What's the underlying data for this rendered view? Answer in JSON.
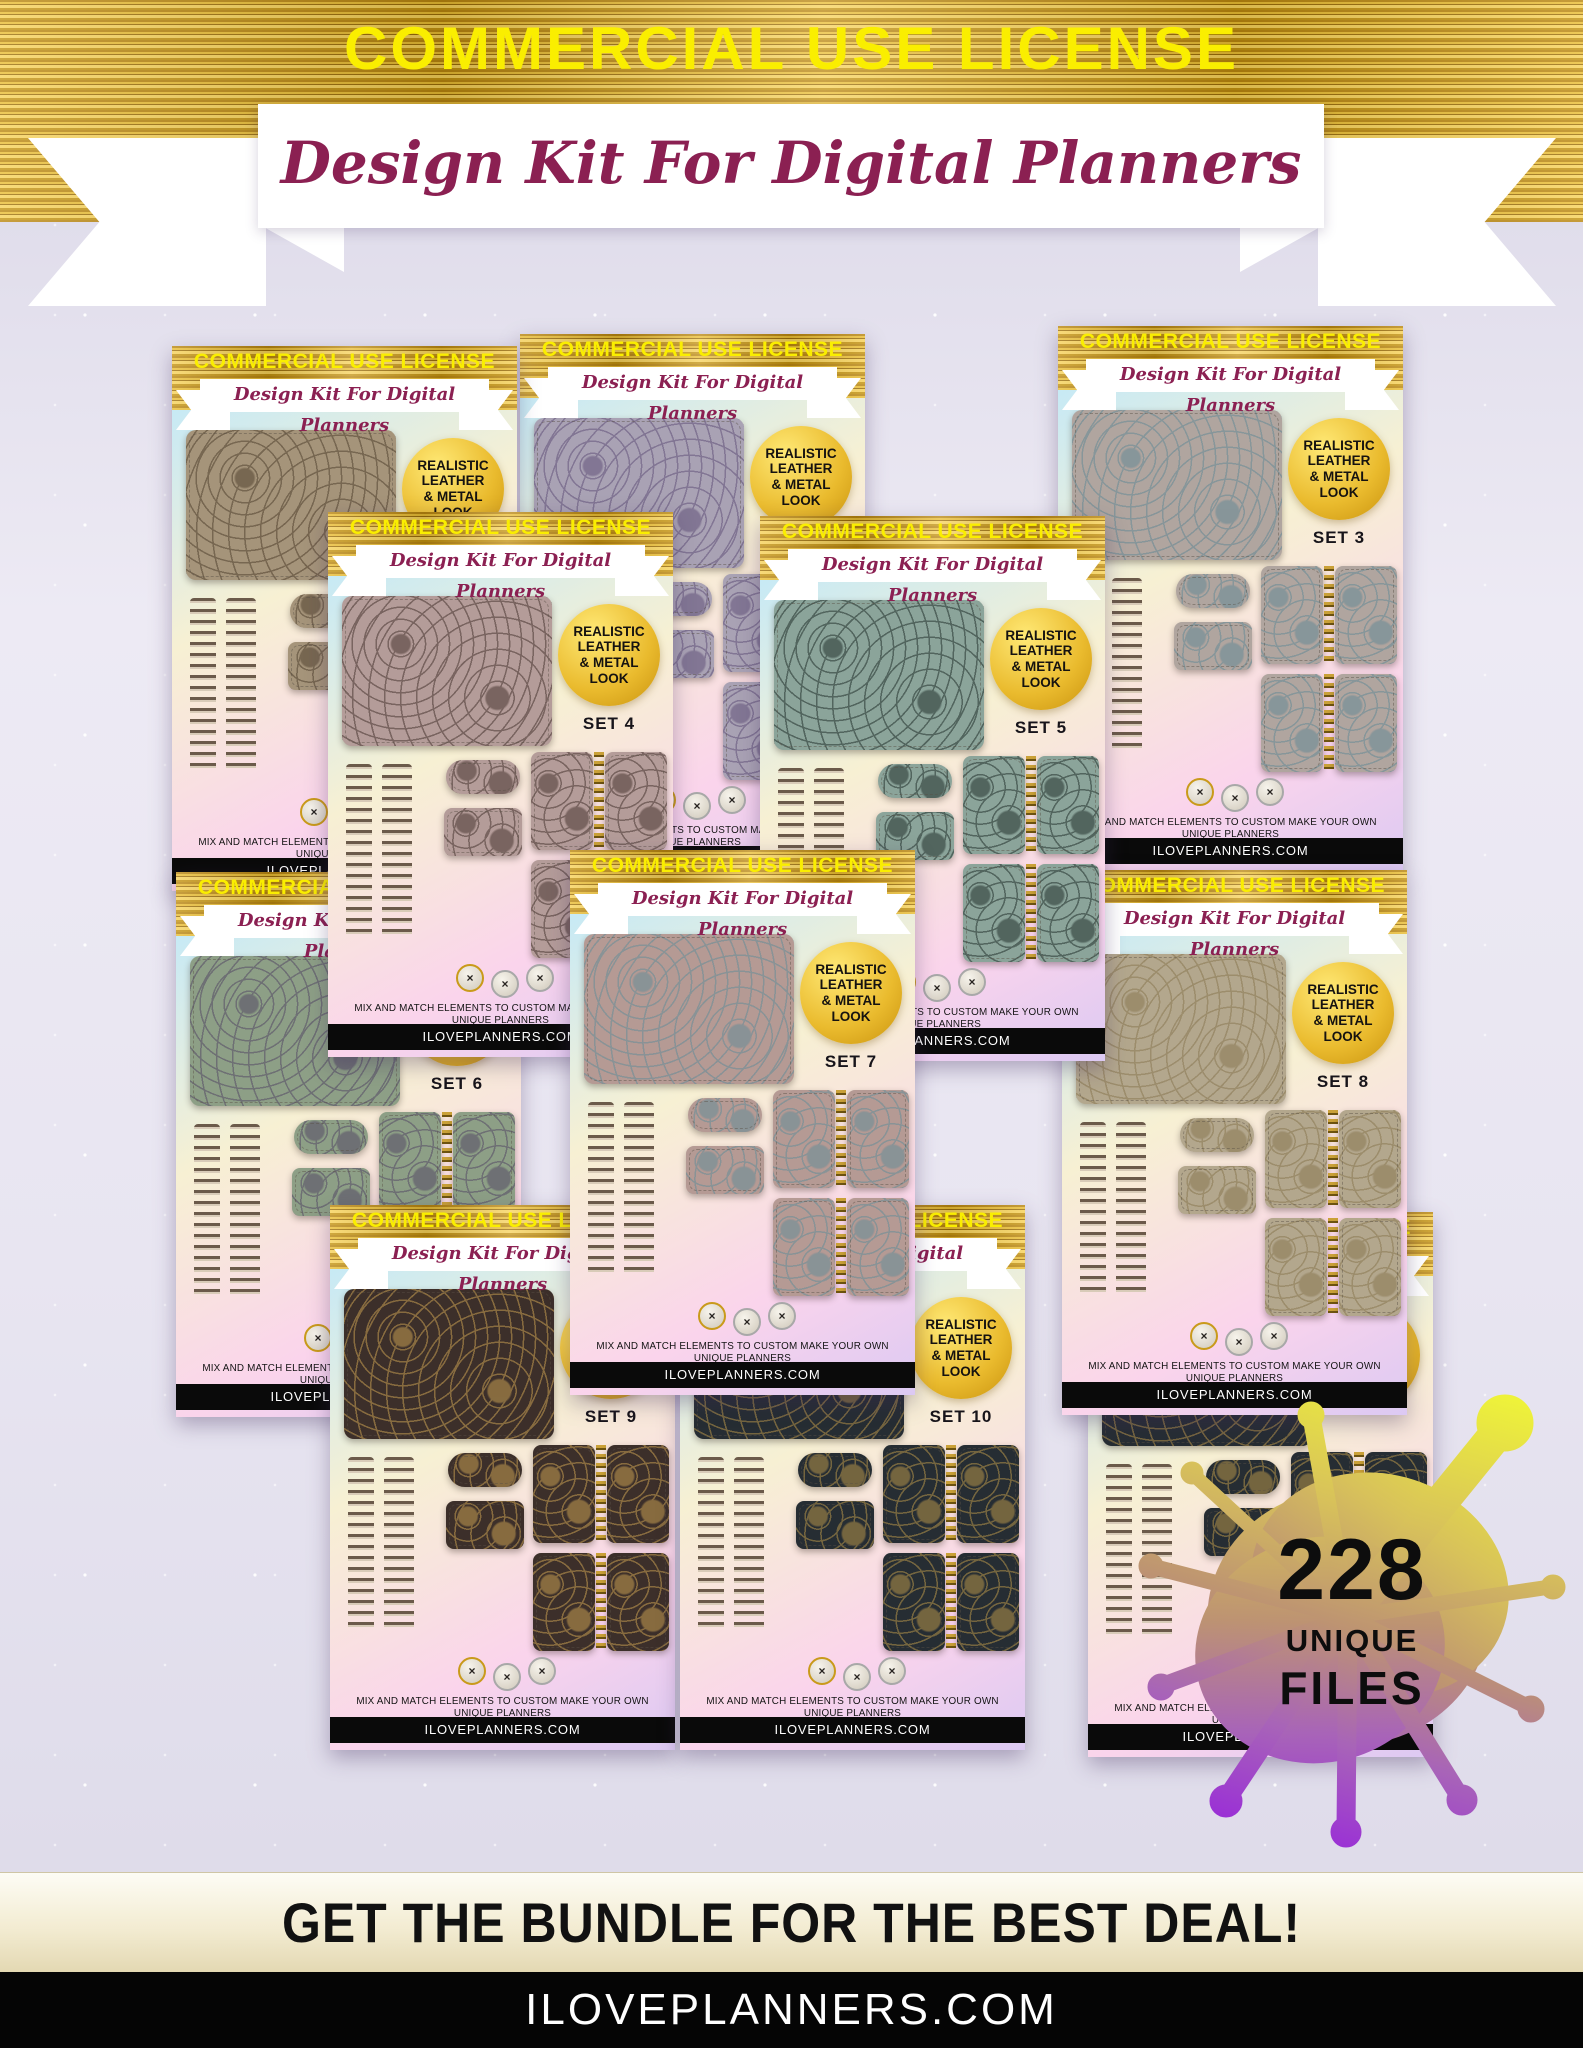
{
  "header": {
    "title": "COMMERCIAL USE LICENSE",
    "subtitle": "Design Kit For Digital Planners",
    "title_color": "#faee00",
    "subtitle_color": "#8b2052",
    "band_color": "#d9a61d"
  },
  "card_common": {
    "banner": "COMMERCIAL USE LICENSE",
    "ribbon": "Design Kit For Digital Planners",
    "badge_lines": [
      "REALISTIC",
      "LEATHER",
      "& METAL",
      "LOOK"
    ],
    "caption": "MIX AND MATCH ELEMENTS TO CUSTOM MAKE YOUR OWN UNIQUE PLANNERS",
    "website": "ILOVEPLANNERS.COM"
  },
  "cards": [
    {
      "id": "set-1",
      "label": "SET 1",
      "pos": {
        "x": 172,
        "y": 346,
        "z": 2
      },
      "colors": {
        "leather": "#a5947a",
        "motif": "#4a3a28",
        "motif_opacity": 0.5
      }
    },
    {
      "id": "set-2",
      "label": "SET 2",
      "pos": {
        "x": 520,
        "y": 334,
        "z": 1
      },
      "colors": {
        "leather": "#a9a2b4",
        "motif": "#5c4a74",
        "motif_opacity": 0.5
      }
    },
    {
      "id": "set-3",
      "label": "SET 3",
      "pos": {
        "x": 1058,
        "y": 326,
        "z": 2
      },
      "colors": {
        "leather": "#b0a59f",
        "motif": "#5f8795",
        "motif_opacity": 0.5
      }
    },
    {
      "id": "set-4",
      "label": "SET 4",
      "pos": {
        "x": 328,
        "y": 512,
        "z": 4
      },
      "colors": {
        "leather": "#b49c99",
        "motif": "#4a3832",
        "motif_opacity": 0.55
      }
    },
    {
      "id": "set-5",
      "label": "SET 5",
      "pos": {
        "x": 760,
        "y": 516,
        "z": 4
      },
      "colors": {
        "leather": "#8ba49a",
        "motif": "#2e3c38",
        "motif_opacity": 0.6
      }
    },
    {
      "id": "set-6",
      "label": "SET 6",
      "pos": {
        "x": 176,
        "y": 872,
        "z": 3
      },
      "colors": {
        "leather": "#8d9f86",
        "motif": "#564a66",
        "motif_opacity": 0.55
      }
    },
    {
      "id": "set-7",
      "label": "SET 7",
      "pos": {
        "x": 570,
        "y": 850,
        "z": 6
      },
      "colors": {
        "leather": "#b59a94",
        "motif": "#5e8b98",
        "motif_opacity": 0.5
      }
    },
    {
      "id": "set-8",
      "label": "SET 8",
      "pos": {
        "x": 1062,
        "y": 870,
        "z": 3
      },
      "colors": {
        "leather": "#b3a78d",
        "motif": "#8d7c58",
        "motif_opacity": 0.6
      }
    },
    {
      "id": "set-9",
      "label": "SET 9",
      "pos": {
        "x": 330,
        "y": 1205,
        "z": 5
      },
      "colors": {
        "leather": "#3c2f2a",
        "motif": "#b08d4c",
        "motif_opacity": 0.65
      }
    },
    {
      "id": "set-10",
      "label": "SET 10",
      "pos": {
        "x": 680,
        "y": 1205,
        "z": 5
      },
      "colors": {
        "leather": "#262d33",
        "motif": "#a98a48",
        "motif_opacity": 0.6
      }
    },
    {
      "id": "partial",
      "label": "",
      "pos": {
        "x": 1088,
        "y": 1212,
        "z": 0
      },
      "colors": {
        "leather": "#262d33",
        "motif": "#a98a48",
        "motif_opacity": 0.6
      }
    }
  ],
  "splat": {
    "count": "228",
    "line1": "UNIQUE",
    "line2": "FILES",
    "gradient_top": "#eef23a",
    "gradient_mid": "#bd9372",
    "gradient_bottom": "#9a2fd6"
  },
  "footer": {
    "tagline": "GET THE BUNDLE FOR THE BEST DEAL!",
    "website": "ILOVEPLANNERS.COM"
  }
}
